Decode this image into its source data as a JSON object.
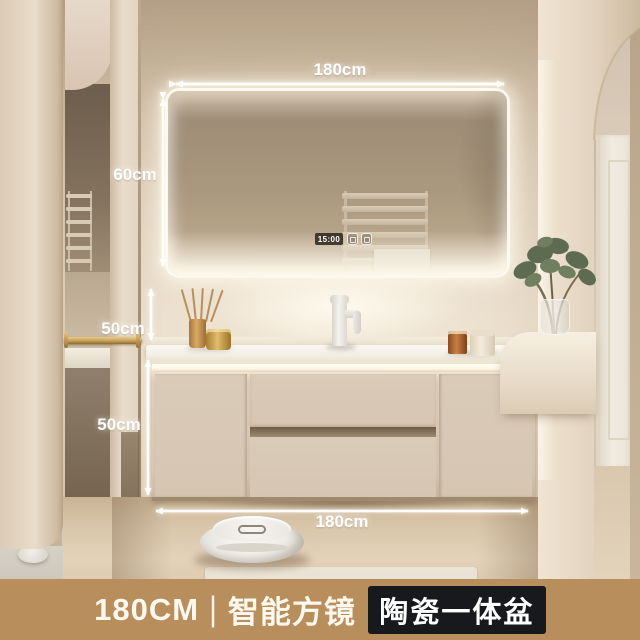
{
  "annotations": {
    "top_width": "180cm",
    "mirror_height": "60cm",
    "splash_height": "50cm",
    "cabinet_height": "50cm",
    "bottom_width": "180cm"
  },
  "mirror": {
    "clock_time": "15:00"
  },
  "banner": {
    "size": "180CM",
    "separator": "|",
    "feature_mirror": "智能方镜",
    "feature_basin": "陶瓷一体盆"
  },
  "colors": {
    "banner_bg": "#b78e5c",
    "banner_text": "#fdf8ee",
    "banner_box_bg": "#17191d",
    "banner_box_text": "#ffffff",
    "annotation": "#ffffff",
    "brass": "#c7a05a",
    "led_glow": "#fff6e3"
  }
}
